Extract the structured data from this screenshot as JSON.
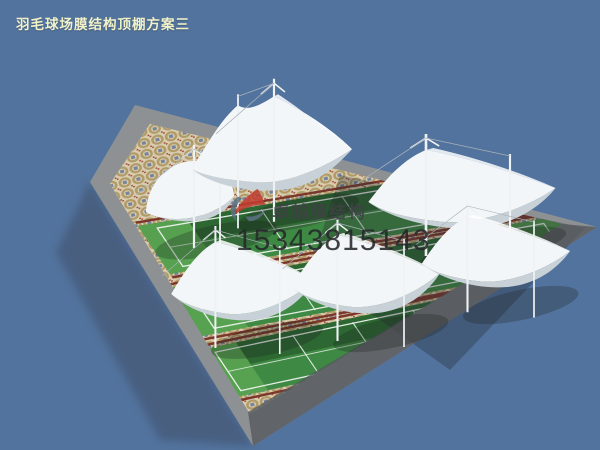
{
  "title": "羽毛球场膜结构顶棚方案三",
  "watermark": {
    "brand": "卓越膜结构",
    "phone": "15343815143"
  },
  "colors": {
    "sky": "#52739d",
    "title_text": "#f1f2c8",
    "canopy": "#f3f6f8",
    "canopy_under": "#c7d1d7",
    "canopy_shade": "#e1e8ec",
    "canopy_ridge": "#fdfeff",
    "court_green": "#3e8943",
    "court_green_dark": "#2a5f2f",
    "court_apron": "#58a351",
    "court_line": "#eef3ee",
    "court_edge_red": "#7c362b",
    "mosaic_base": "#d8cdaf",
    "mosaic_ring": "#b09a67",
    "mosaic_square": "#77839c",
    "mosaic_red": "#a34a38",
    "border_gray": "#8e9194",
    "border_gray_dark": "#565a5f",
    "mast": "#eef2f4",
    "cable": "#a8b2b9",
    "watermark_text": "#3f4245",
    "phone_text": "#26282a",
    "logo_red": "#c23c31",
    "logo_blue": "#5c7287"
  },
  "scene": {
    "plaza_outer": [
      [
        135,
        105
      ],
      [
        597,
        227
      ],
      [
        253,
        446
      ],
      [
        90,
        182
      ]
    ],
    "plaza_inner": [
      [
        150,
        124
      ],
      [
        562,
        224
      ],
      [
        250,
        414
      ],
      [
        110,
        184
      ]
    ],
    "strips": [
      {
        "tl": [
          138,
          226
        ],
        "tr": [
          540,
          158
        ],
        "br": [
          572,
          204
        ],
        "bl": [
          170,
          274
        ]
      },
      {
        "tl": [
          170,
          288
        ],
        "tr": [
          556,
          216
        ],
        "br": [
          588,
          262
        ],
        "bl": [
          202,
          336
        ]
      },
      {
        "tl": [
          200,
          350
        ],
        "tr": [
          500,
          287
        ],
        "br": [
          532,
          333
        ],
        "bl": [
          232,
          398
        ]
      }
    ],
    "canopies": [
      {
        "type": "dome",
        "x": 190,
        "y": 190,
        "sx": 1.0,
        "sy": 1.0
      },
      {
        "type": "twin",
        "x": 272,
        "y": 158,
        "sx": 1.0,
        "sy": 1.1
      },
      {
        "type": "saddle",
        "x": 462,
        "y": 198,
        "sx": 1.2,
        "sy": 1.0
      },
      {
        "type": "saddle",
        "x": 243,
        "y": 290,
        "sx": 0.92,
        "sy": 1.0
      },
      {
        "type": "saddle",
        "x": 366,
        "y": 283,
        "sx": 0.95,
        "sy": 1.0
      },
      {
        "type": "saddle",
        "x": 496,
        "y": 260,
        "sx": 0.95,
        "sy": 0.9
      }
    ]
  }
}
